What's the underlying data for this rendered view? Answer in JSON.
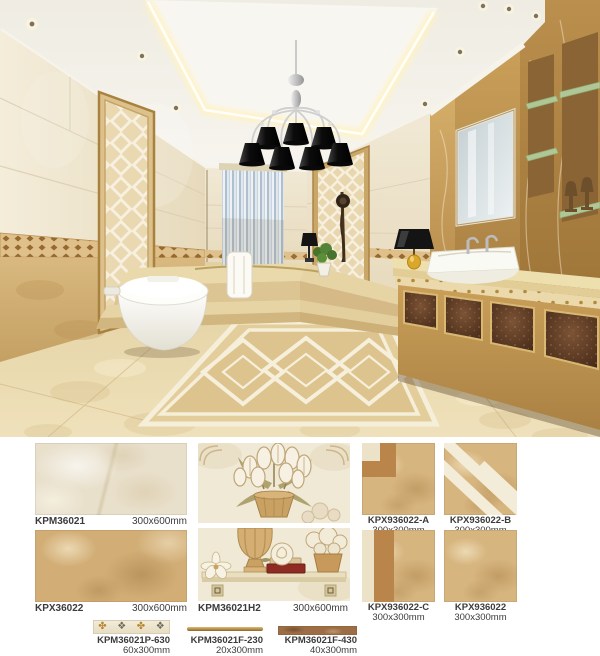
{
  "colors": {
    "page_bg": "#ffffff",
    "label_text": "#3b3b3b",
    "tile_cream": "#e9e0cc",
    "tile_tan": "#d2ae76",
    "tile_gold": "#d7b57e",
    "tile_brown": "#9d6e45",
    "wall_cream": "#efe7d2",
    "wall_tan_low": "#d0ad74",
    "marble_gold": "#c49a58",
    "emperador_brown": "#5a3a24",
    "glass_green": "#b5cf9f",
    "lamp_black": "#141414",
    "chandelier_silver": "#c9c9c9",
    "porcelain_white": "#f8f7f3",
    "floor_beige": "#e9d8ab",
    "curtain_blue": "#aebfcf",
    "accent_red": "#8e2b22",
    "cove_glow": "#fff3c4",
    "motif_gold": "#b8862f",
    "motif_gray": "#6f6b5c"
  },
  "products": {
    "wall_tiles": [
      {
        "code": "KPM36021",
        "size": "300x600mm"
      },
      {
        "code": "KPX36022",
        "size": "300x600mm"
      }
    ],
    "mural": {
      "code": "KPM36021H2",
      "size": "300x600mm"
    },
    "floor_tiles": [
      {
        "code": "KPX936022-A",
        "size": "300x300mm"
      },
      {
        "code": "KPX936022-B",
        "size": "300x300mm"
      },
      {
        "code": "KPX936022-C",
        "size": "300x300mm"
      },
      {
        "code": "KPX936022",
        "size": "300x300mm"
      }
    ],
    "borders": [
      {
        "code": "KPM36021P-630",
        "size": "60x300mm"
      },
      {
        "code": "KPM36021F-230",
        "size": "20x300mm"
      },
      {
        "code": "KPM36021F-430",
        "size": "40x300mm"
      }
    ],
    "border_motifs": [
      "✤",
      "❖",
      "✤",
      "❖"
    ]
  }
}
